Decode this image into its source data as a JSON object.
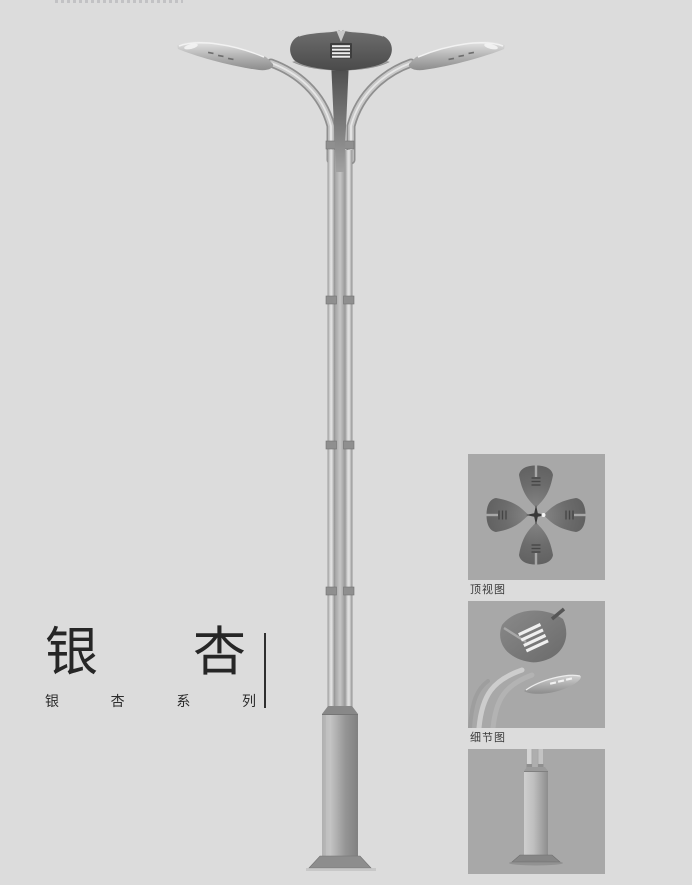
{
  "page": {
    "background": "#dcdcdc"
  },
  "title_block": {
    "title": "银杏",
    "title_chars": [
      "银",
      "杏"
    ],
    "subtitle": "银杏系列",
    "subtitle_chars": [
      "银",
      "杏",
      "系",
      "列"
    ],
    "text_color": "#262626"
  },
  "detail_panels": {
    "panel_bg": "#a8a8a8",
    "items": [
      {
        "label": "顶视图"
      },
      {
        "label": "细节图"
      },
      {
        "label": null
      }
    ]
  },
  "colors": {
    "page_bg": "#dcdcdc",
    "panel_bg": "#a8a8a8",
    "metal_dark": "#4c4c4c",
    "metal_mid": "#8f8f8f",
    "metal_light": "#d6d6d6",
    "title_text": "#262626",
    "label_text": "#3a3a3a"
  }
}
